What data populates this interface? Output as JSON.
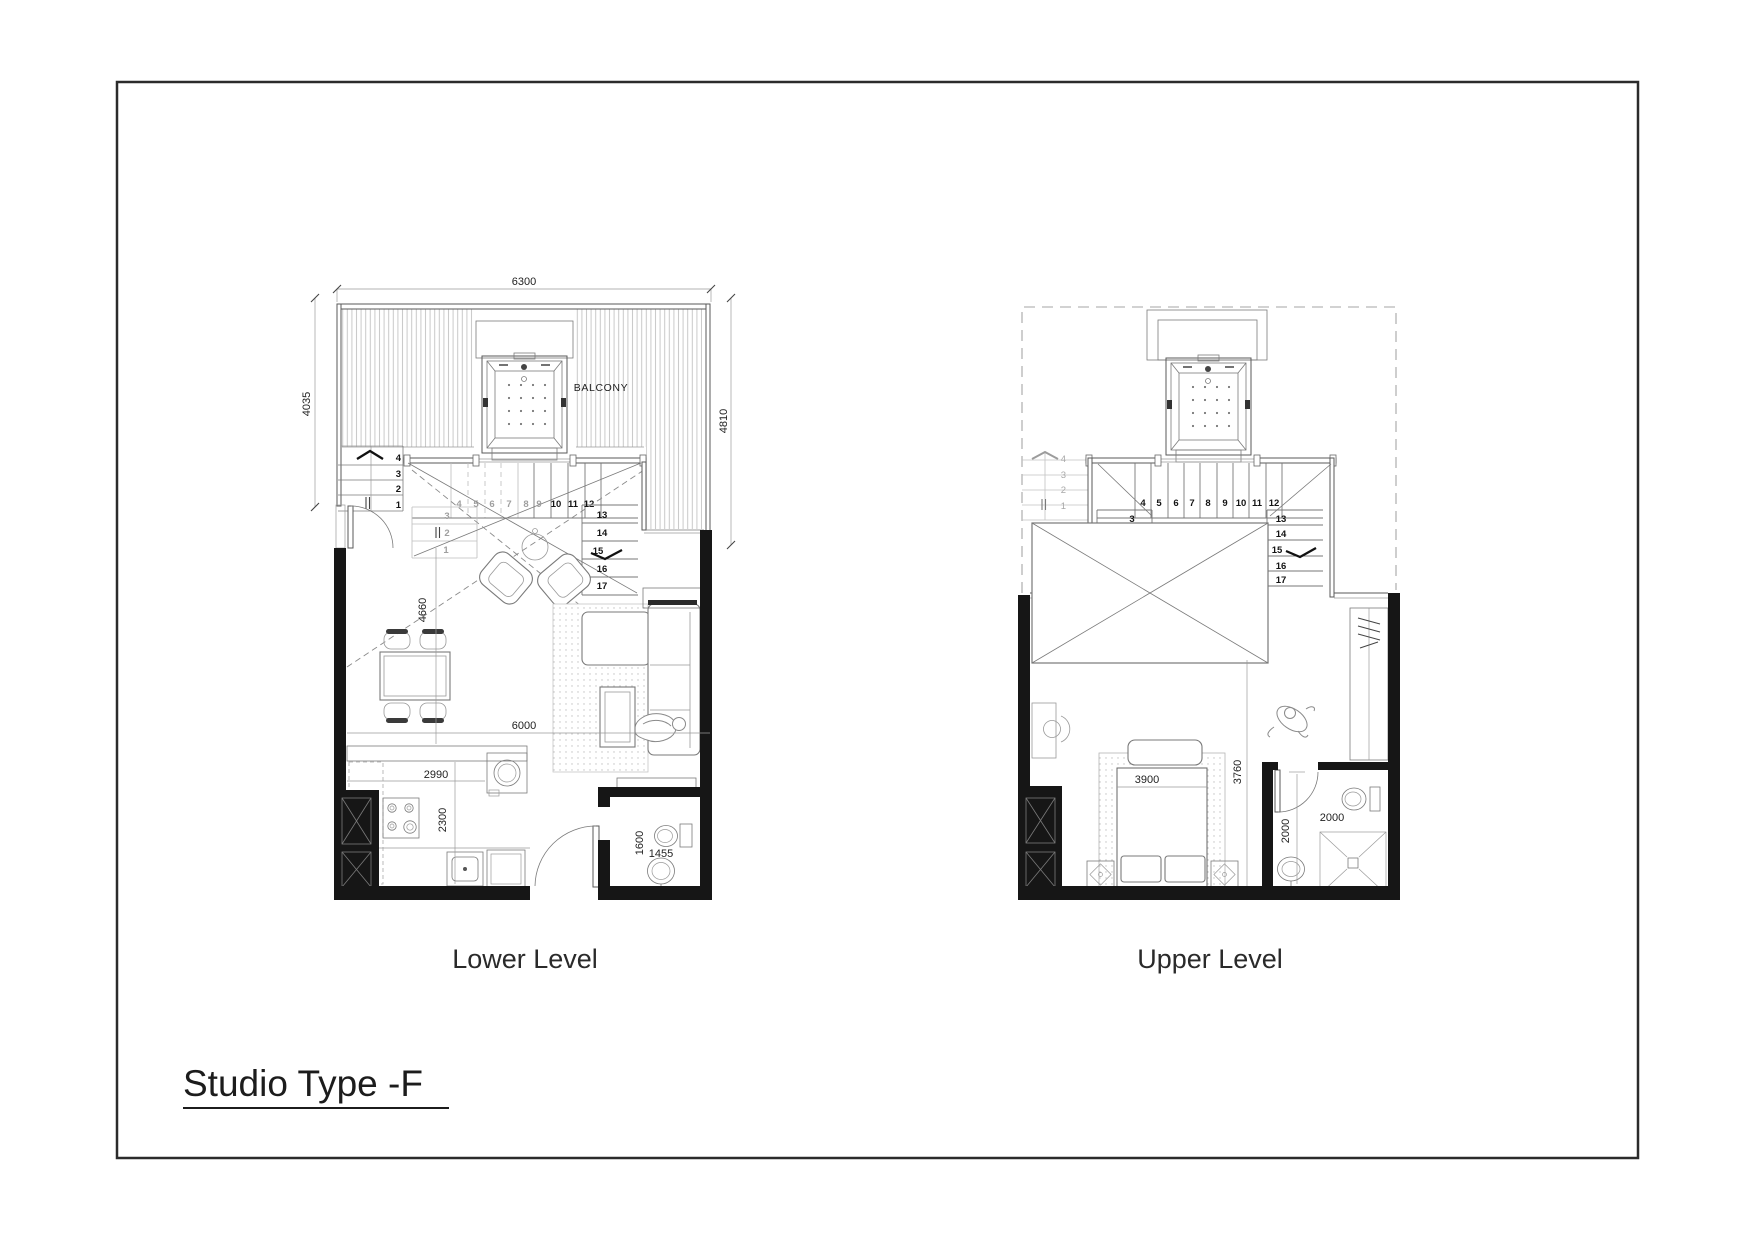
{
  "title_block": {
    "project_title": "Studio Type -F"
  },
  "colors": {
    "wall": "#161616",
    "line": "#5a5a5a",
    "hatch": "#c9c9c9"
  },
  "plans": {
    "lower": {
      "label": "Lower Level",
      "balcony_label": "BALCONY",
      "dims": {
        "width_top": "6300",
        "height_left": "4035",
        "height_right": "4810",
        "living_depth": "4660",
        "living_width": "6000",
        "kitchen_run": "2990",
        "kitchen_depth": "2300",
        "bath_depth": "1600",
        "bath_width": "1455"
      },
      "stairs": {
        "outside": [
          "1",
          "2",
          "3",
          "4"
        ],
        "flight_low": [
          "1",
          "2",
          "3"
        ],
        "flight_mid": [
          "4",
          "5",
          "6",
          "7",
          "8",
          "9",
          "10",
          "11",
          "12"
        ],
        "flight_high": [
          "13",
          "14",
          "15",
          "16",
          "17"
        ]
      }
    },
    "upper": {
      "label": "Upper Level",
      "dims": {
        "bed_width": "3900",
        "bedroom_depth": "3760",
        "bath_depth": "2000",
        "bath_width": "2000"
      },
      "stairs": {
        "outside": [
          "1",
          "2",
          "3",
          "4"
        ],
        "flight_low": [
          "1",
          "2",
          "3"
        ],
        "flight_mid": [
          "4",
          "5",
          "6",
          "7",
          "8",
          "9",
          "10",
          "11",
          "12"
        ],
        "flight_high": [
          "13",
          "14",
          "15",
          "16",
          "17"
        ]
      }
    }
  }
}
